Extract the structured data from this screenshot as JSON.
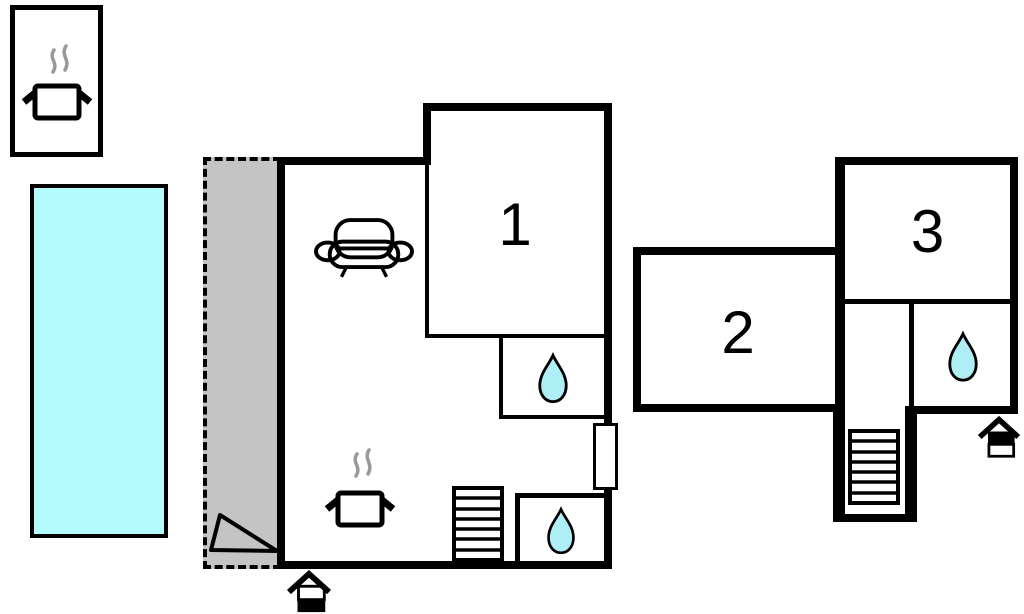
{
  "diagram": {
    "type": "vacation-home-floor-plan",
    "rooms": [
      {
        "id": "room1",
        "label": "1"
      },
      {
        "id": "room2",
        "label": "2"
      },
      {
        "id": "room3",
        "label": "3"
      }
    ],
    "features": [
      "outdoor-cooking-area",
      "swimming-pool",
      "covered-terrace",
      "living-room-with-sofa",
      "kitchen-with-cooking-pot",
      "two-bathrooms-main-house",
      "stairs-main-house",
      "main-entrance",
      "annex-bathroom",
      "annex-stairwell",
      "annex-entrance"
    ],
    "icons": {
      "cooking_pot": "cooking-pot-icon",
      "sofa": "sofa-icon",
      "water_drop": "water-drop-icon",
      "stairs": "stairs-icon",
      "entrance": "entrance-arrow-icon"
    }
  },
  "colors": {
    "bg": "#ffffff",
    "wall": "#000000",
    "pool-fill": "#b3fbfc",
    "terrace-fill": "#c4c4c4",
    "drop-fill": "#aeeff5",
    "steam": "#999999"
  }
}
